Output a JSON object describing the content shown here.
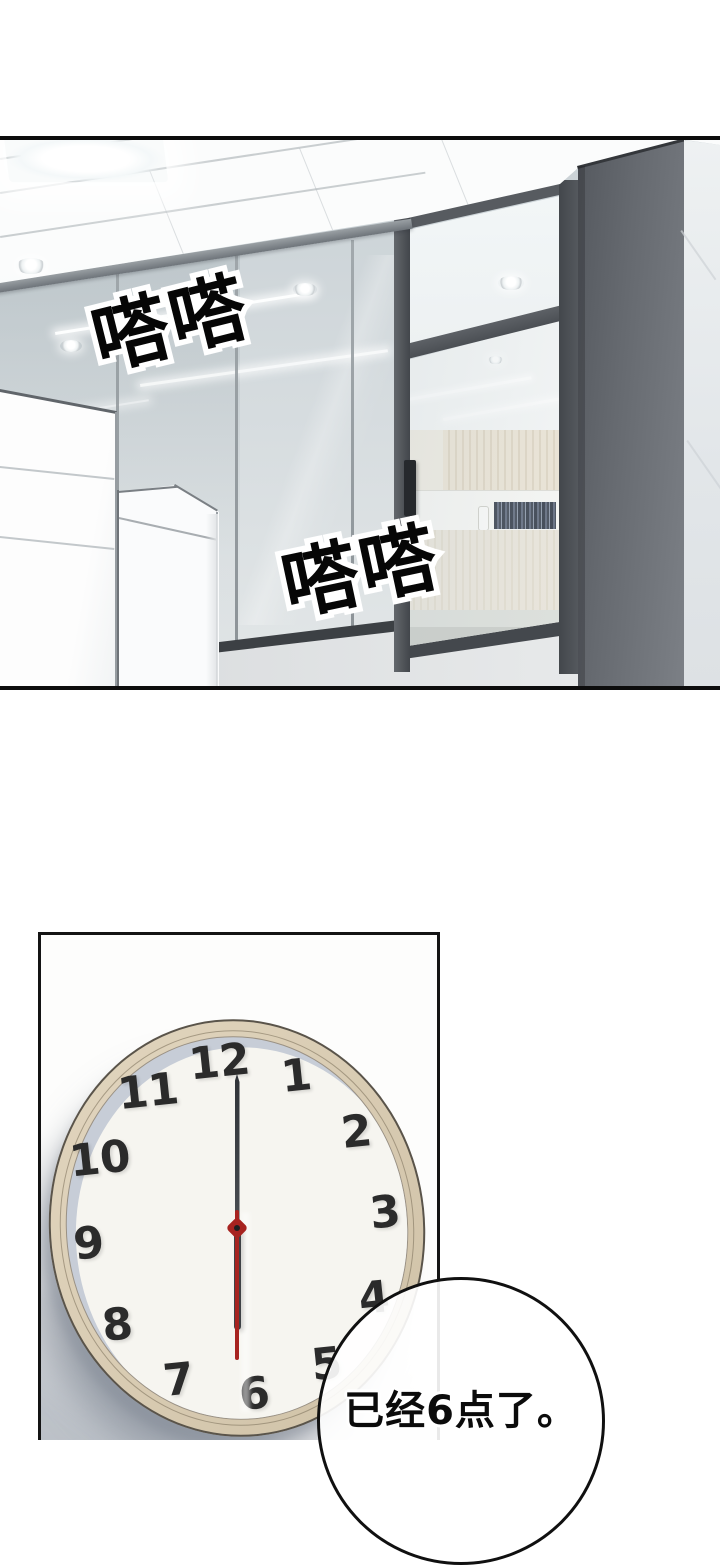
{
  "page": {
    "type": "webtoon comic page",
    "background": "#ffffff"
  },
  "office_panel": {
    "scene": "office hallway with glass partition wall, dark sliding door, inner reception room and white foreground cabinets",
    "sfx_top": "嗒嗒",
    "sfx_bottom": "嗒嗒"
  },
  "clock_panel": {
    "scene": "round wall clock on a pale wall showing six o'clock",
    "clock": {
      "numerals": [
        "12",
        "1",
        "2",
        "3",
        "4",
        "5",
        "6",
        "7",
        "8",
        "9",
        "10",
        "11"
      ],
      "time_shown": "6:00",
      "hour_hand_points_to": "6",
      "minute_hand_points_to": "12",
      "second_hand_points_to": "6"
    }
  },
  "speech_bubble": {
    "text": "已经6点了。"
  },
  "colors": {
    "panel_border": "#141414",
    "door_frame": "#4b4f54",
    "pillar": "#6a6e74",
    "glass_wall": "#d2d9db",
    "interior_slat_wall": "#e7ddc9",
    "clock_rim": "#d6c9b1",
    "clock_face": "#f6f5f0",
    "clock_numerals": "#2b2b2b",
    "second_hand": "#a72320",
    "sfx_fill": "#000000",
    "sfx_outline": "#ffffff"
  }
}
